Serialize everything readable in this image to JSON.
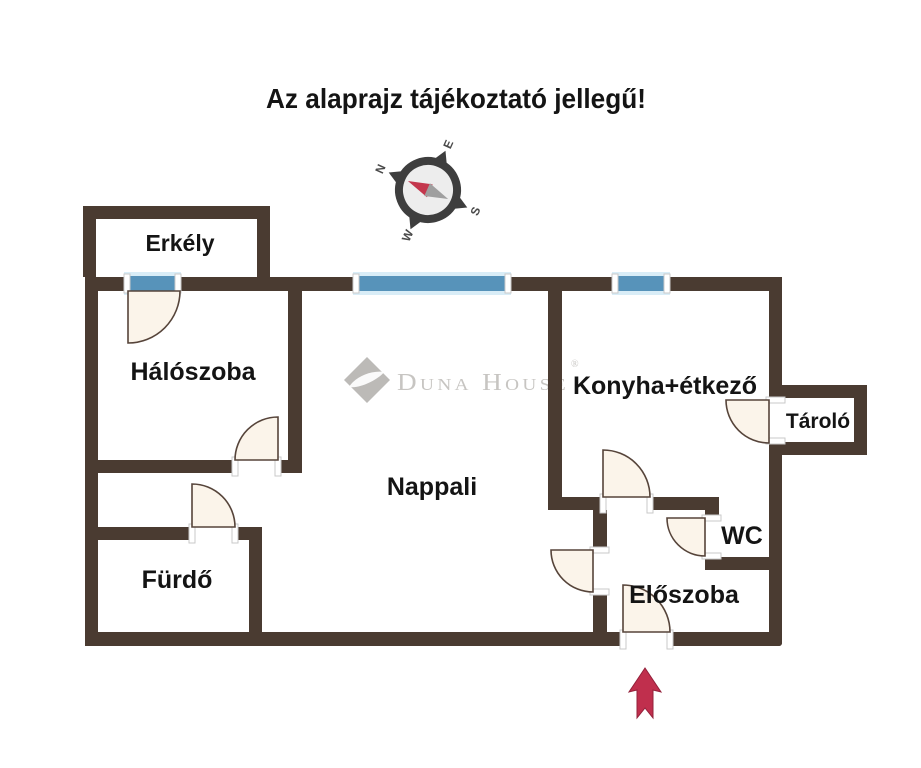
{
  "title": "Az alaprajz tájékoztató jellegű!",
  "compass": {
    "n": "N",
    "e": "E",
    "s": "S",
    "w": "W"
  },
  "watermark": {
    "brand": "Duna House",
    "registered": "®"
  },
  "rooms": {
    "balcony": "Erkély",
    "bedroom": "Hálószoba",
    "living": "Nappali",
    "kitchen": "Konyha+étkező",
    "storage": "Tároló",
    "wc": "WC",
    "hall": "Előszoba",
    "bath": "Fürdő"
  },
  "palette": {
    "bg": "#ffffff",
    "wall": "#4a3b31",
    "window": "#5793ba",
    "window_glow": "#d9edf7",
    "door_fill": "#fbf4ea",
    "door_stroke": "#56443a",
    "post_fill": "#ffffff",
    "post_stroke": "#c9c9c9",
    "arrow": "#c02f4d",
    "arrow_dark": "#93203a",
    "watermark": "#c7c5c2",
    "watermark_logo": "#bcbab7",
    "text": "#141414",
    "compass_ring": "#3e3e3e",
    "compass_face": "#ededed",
    "needle_red": "#c4374d",
    "needle_gray": "#9f9f9f"
  }
}
